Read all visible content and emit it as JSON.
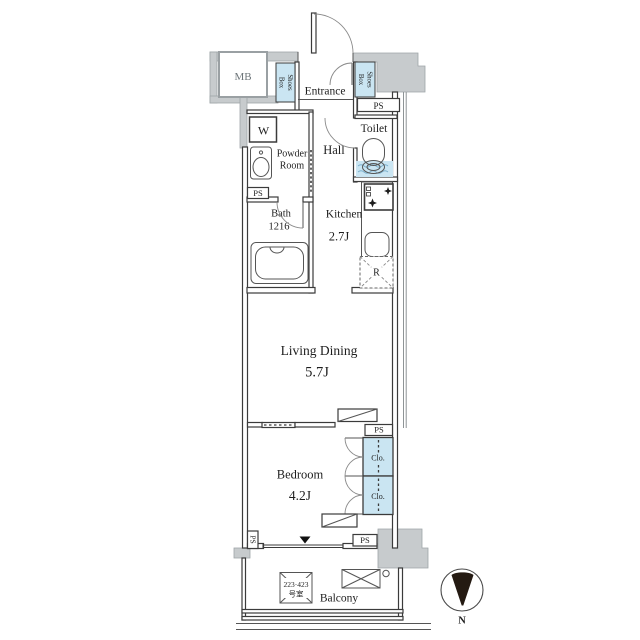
{
  "floorplan": {
    "rooms": {
      "entrance": "Entrance",
      "hall": "Hall",
      "toilet": "Toilet",
      "powder_line1": "Powder",
      "powder_line2": "Room",
      "bath_line1": "Bath",
      "bath_line2": "1216",
      "kitchen": "Kitchen",
      "kitchen_size": "2.7J",
      "living": "Living Dining",
      "living_size": "5.7J",
      "bedroom": "Bedroom",
      "bedroom_size": "4.2J",
      "balcony": "Balcony"
    },
    "fixtures": {
      "meter_box": "MB",
      "pipe_space": "PS",
      "washer": "W",
      "refrigerator": "R",
      "shoes_line1": "Shoes",
      "shoes_line2": "Box",
      "closet": "Clo."
    },
    "annotations": {
      "room_number_line1": "223·423",
      "room_number_line2": "号室",
      "compass_north": "N"
    },
    "colors": {
      "fixture_blue": "#cae5f2",
      "wall_gray": "#c7cbcd",
      "line_dark": "#3b3b3b",
      "needle": "#241a12"
    }
  }
}
